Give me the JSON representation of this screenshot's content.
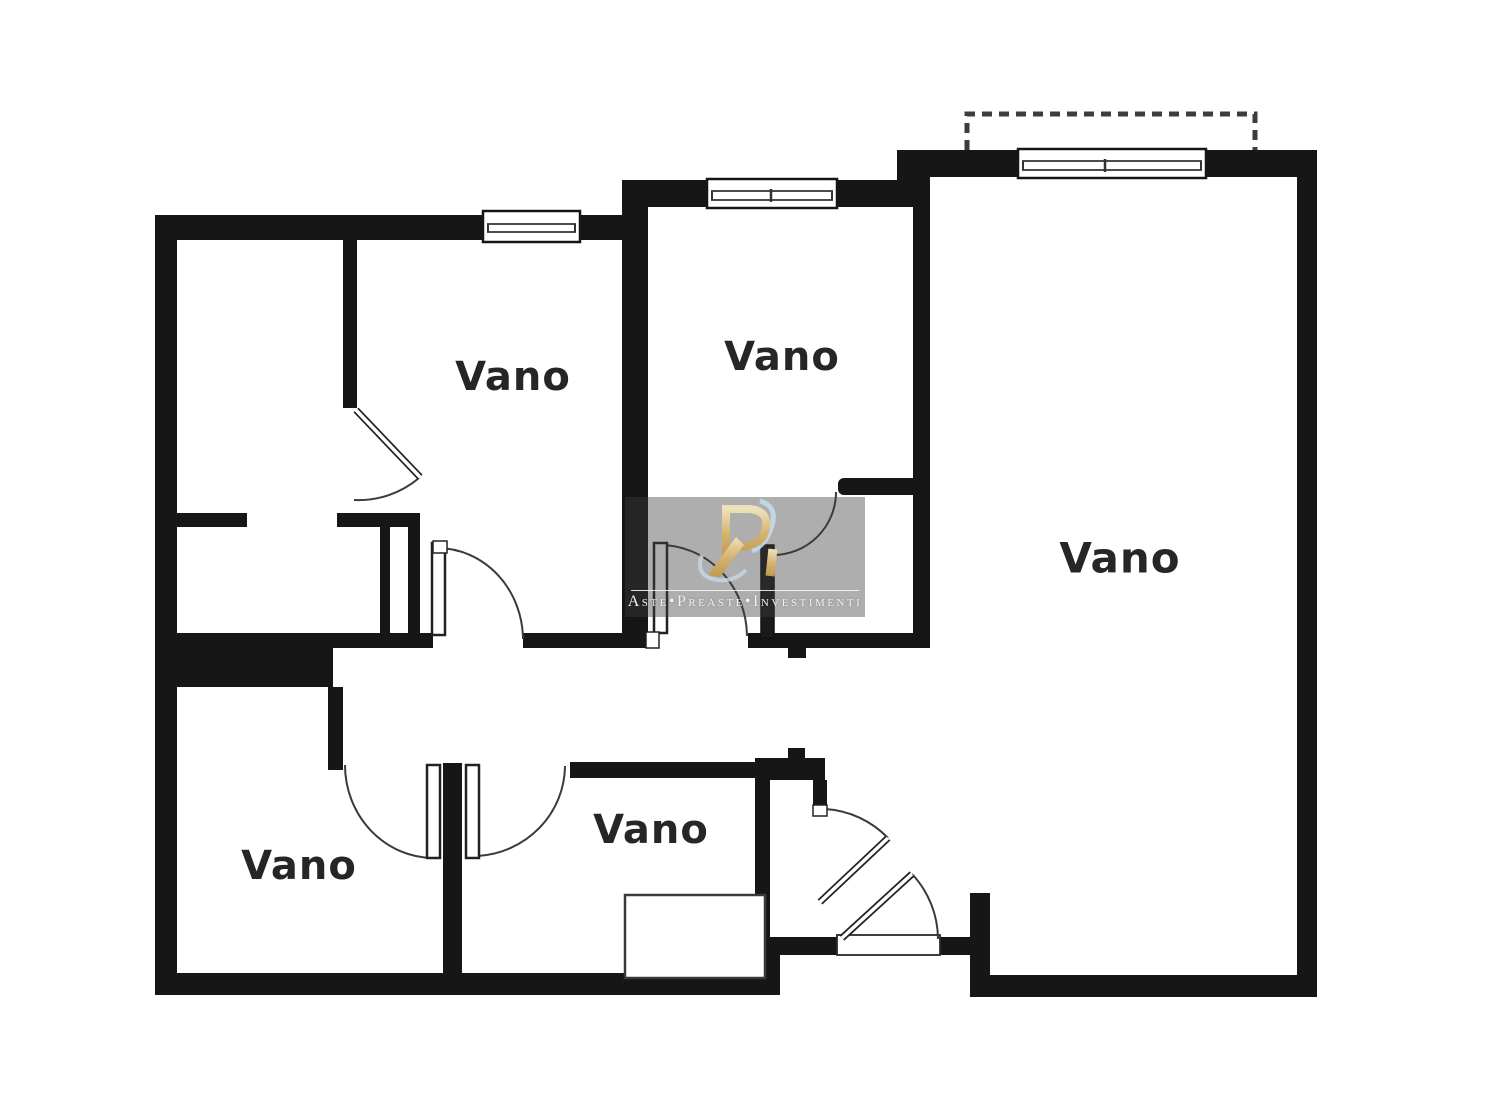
{
  "plan_title": "floor-plan",
  "rooms": [
    {
      "label": "Vano"
    },
    {
      "label": "Vano"
    },
    {
      "label": "Vano"
    },
    {
      "label": "Vano"
    },
    {
      "label": "Vano"
    }
  ],
  "watermark": {
    "text": "Aste•Preaste•Investimenti",
    "logo": "RI-monogram-logo"
  },
  "colors": {
    "wall": "#161616",
    "thin_line": "#333333",
    "logo_gold": "#d6b470",
    "logo_gold_light": "#efe2bb",
    "swoosh_blue": "#c3d9ea",
    "watermark_bg": "rgba(62,62,62,0.42)",
    "watermark_text": "#f2f2f2"
  }
}
